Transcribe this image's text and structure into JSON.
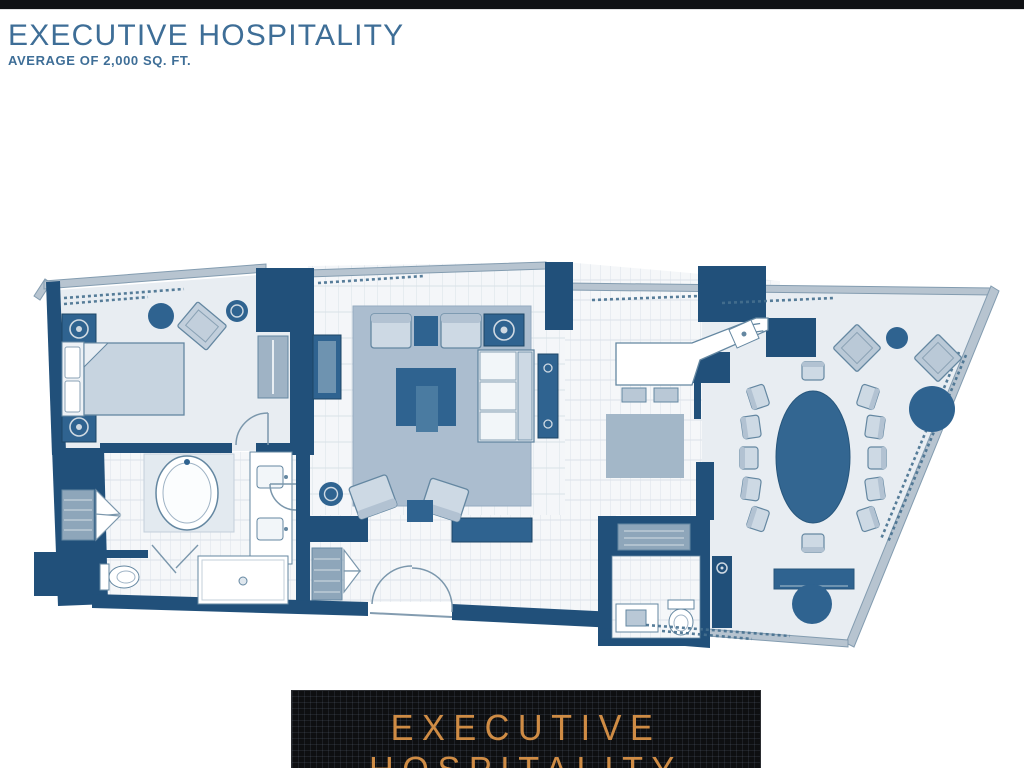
{
  "top_bar": {
    "color": "#101114"
  },
  "header": {
    "title": "EXECUTIVE HOSPITALITY",
    "subtitle": "AVERAGE OF 2,000 SQ. FT.",
    "text_color": "#3e6e97"
  },
  "footer": {
    "line1": "EXECUTIVE",
    "line2": "HOSPITALITY",
    "text_color": "#cf8c45",
    "background": "#0e0f11"
  },
  "floor_plan": {
    "kind": "hotel-suite-floor-plan",
    "colors": {
      "wall": "#21507a",
      "window_wall": "#b7c4d0",
      "floor": "#e8edf2",
      "tile_line": "#d9e1e8",
      "rug": "#abbdcf",
      "furniture_dark": "#2f6390",
      "furniture_light": "#cdd9e4",
      "fixture_white": "#ffffff"
    },
    "rooms": [
      {
        "name": "bedroom",
        "furniture": [
          "bed",
          "headboard-pillows",
          "nightstand-lamp",
          "nightstand-lamp",
          "round-ottoman",
          "chaise-lounge",
          "side-table",
          "closet-rod"
        ]
      },
      {
        "name": "bathroom",
        "furniture": [
          "soaking-tub",
          "double-vanity",
          "toilet",
          "shower",
          "linen-shelves"
        ]
      },
      {
        "name": "entry-hall",
        "furniture": [
          "closet-shelves",
          "console",
          "double-entry-door"
        ]
      },
      {
        "name": "living-room",
        "furniture": [
          "area-rug",
          "armchair",
          "armchair",
          "lamp-table",
          "sofa",
          "media-console",
          "coffee-table",
          "accent-chair",
          "accent-chair",
          "ottoman",
          "round-side-table",
          "wall-console"
        ]
      },
      {
        "name": "kitchenette",
        "furniture": [
          "counter",
          "bar-stool",
          "bar-stool",
          "appliance",
          "kitchen-rug"
        ]
      },
      {
        "name": "dining-room",
        "furniture": [
          "oval-table",
          "dining-chairs-x12",
          "lounge-diamond-chair",
          "lounge-diamond-chair",
          "round-table",
          "large-round-table",
          "credenza",
          "round-cafe-table"
        ]
      },
      {
        "name": "powder-room",
        "furniture": [
          "sink",
          "toilet",
          "luggage-bench"
        ]
      }
    ]
  }
}
